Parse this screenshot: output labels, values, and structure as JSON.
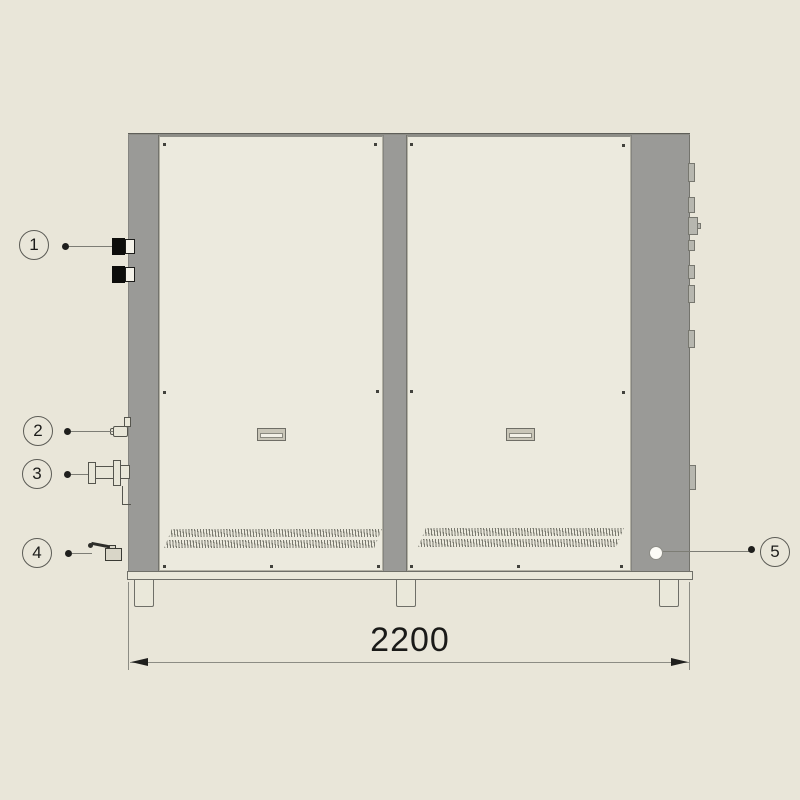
{
  "drawing": {
    "title": "chiller-front-elevation",
    "dimension": {
      "value": "2200"
    },
    "callouts": [
      {
        "label": "1",
        "target": "electrical-connectors"
      },
      {
        "label": "2",
        "target": "drain-nozzle"
      },
      {
        "label": "3",
        "target": "flanged-water-coupling"
      },
      {
        "label": "4",
        "target": "ball-valve"
      },
      {
        "label": "5",
        "target": "round-port"
      }
    ],
    "colors": {
      "background": "#e9e6d9",
      "panel": "#eceade",
      "frame_gray": "#9a9a97",
      "line": "#6f6f68",
      "connector_black": "#0d0d0b"
    }
  }
}
